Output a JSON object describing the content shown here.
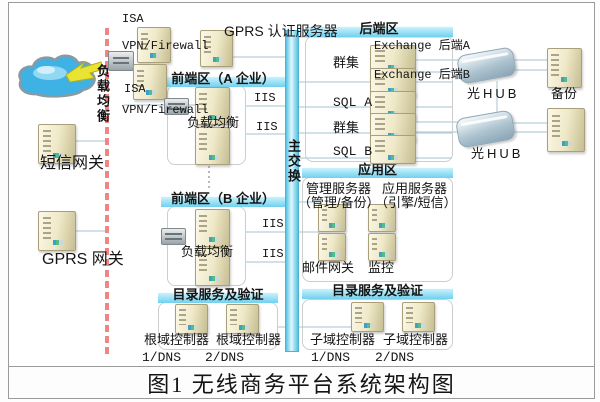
{
  "caption": "图1 无线商务平台系统架构图",
  "colors": {
    "zone_header_bar": "#70d0ee",
    "main_switch_bar": "#54c2e4",
    "dashed_divider": "#f08585",
    "connector_line": "#b7cdd9",
    "server_body": "#efe9c9",
    "cloud": "#3eb2e4",
    "lightning": "#e8e431"
  },
  "icons": {
    "cloud": "internet-cloud-icon",
    "lightning": "lightning-icon",
    "server": "server-icon",
    "hub": "optical-hub-icon",
    "balancer": "load-balancer-icon"
  },
  "left": {
    "lb_vertical": "负载均衡",
    "isa1": "ISA",
    "isa1_fw": "VPN/Firewall",
    "isa2": "ISA",
    "isa2_fw": "VPN/Firewall",
    "sms_gw": "短信网关",
    "gprs_gw": "GPRS 网关"
  },
  "center": {
    "gprs_auth": "GPRS 认证服务器",
    "main_switch": "主交换"
  },
  "zone_a": {
    "title": "前端区（A 企业）",
    "iis1": "IIS",
    "iis2": "IIS",
    "lb": "负载均衡"
  },
  "zone_b": {
    "title": "前端区（B 企业）",
    "iis1": "IIS",
    "iis2": "IIS",
    "lb": "负载均衡"
  },
  "zone_backend": {
    "title": "后端区",
    "exch_a": "Exchange 后端A",
    "exch_b": "Exchange 后端B",
    "cluster1": "群集",
    "sql_a": "SQL A",
    "cluster2": "群集",
    "sql_b": "SQL B"
  },
  "zone_app": {
    "title": "应用区",
    "mgmt_title": "管理服务器",
    "mgmt_sub": "（管理/备份）",
    "app_title": "应用服务器",
    "app_sub": "（引擎/短信）",
    "mail_gw": "邮件网关",
    "monitor": "监控"
  },
  "zone_dir_left": {
    "title": "目录服务及验证",
    "dc1": "根域控制器",
    "dns1": "1/DNS",
    "dc2": "根域控制器",
    "dns2": "2/DNS"
  },
  "zone_dir_right": {
    "title": "目录服务及验证",
    "dc1": "子域控制器",
    "dns1": "1/DNS",
    "dc2": "子域控制器",
    "dns2": "2/DNS"
  },
  "right_col": {
    "hub1": "光HUB",
    "hub2": "光HUB",
    "backup": "备份"
  }
}
